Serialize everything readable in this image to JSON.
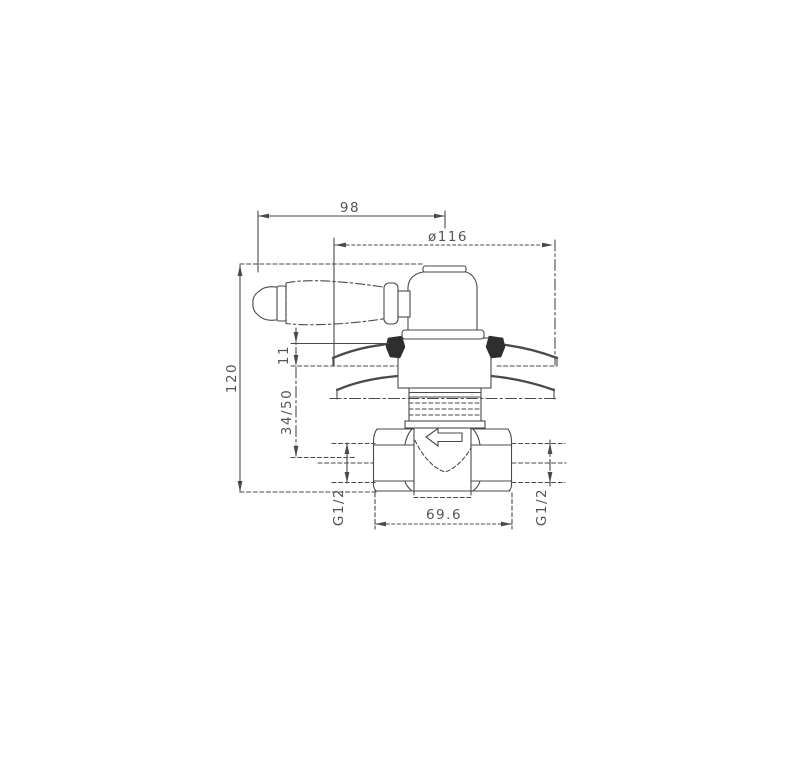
{
  "page": {
    "background": "#ffffff",
    "description": "Technical dimensioned side-elevation drawing of a concealed shower valve with classic lever handle, escutcheon plate, threaded body and hex pipe connections"
  },
  "drawing": {
    "line_color": "#4a4a4a",
    "text_color": "#555555",
    "flow_arrow_direction": "left",
    "dims": {
      "width_top": "98",
      "escutcheon_diameter": "ø116",
      "overall_height": "120",
      "wall_offset": "11",
      "install_depth_range": "34/50",
      "body_width": "69.6",
      "thread_left": "G1/2",
      "thread_right": "G1/2"
    }
  }
}
